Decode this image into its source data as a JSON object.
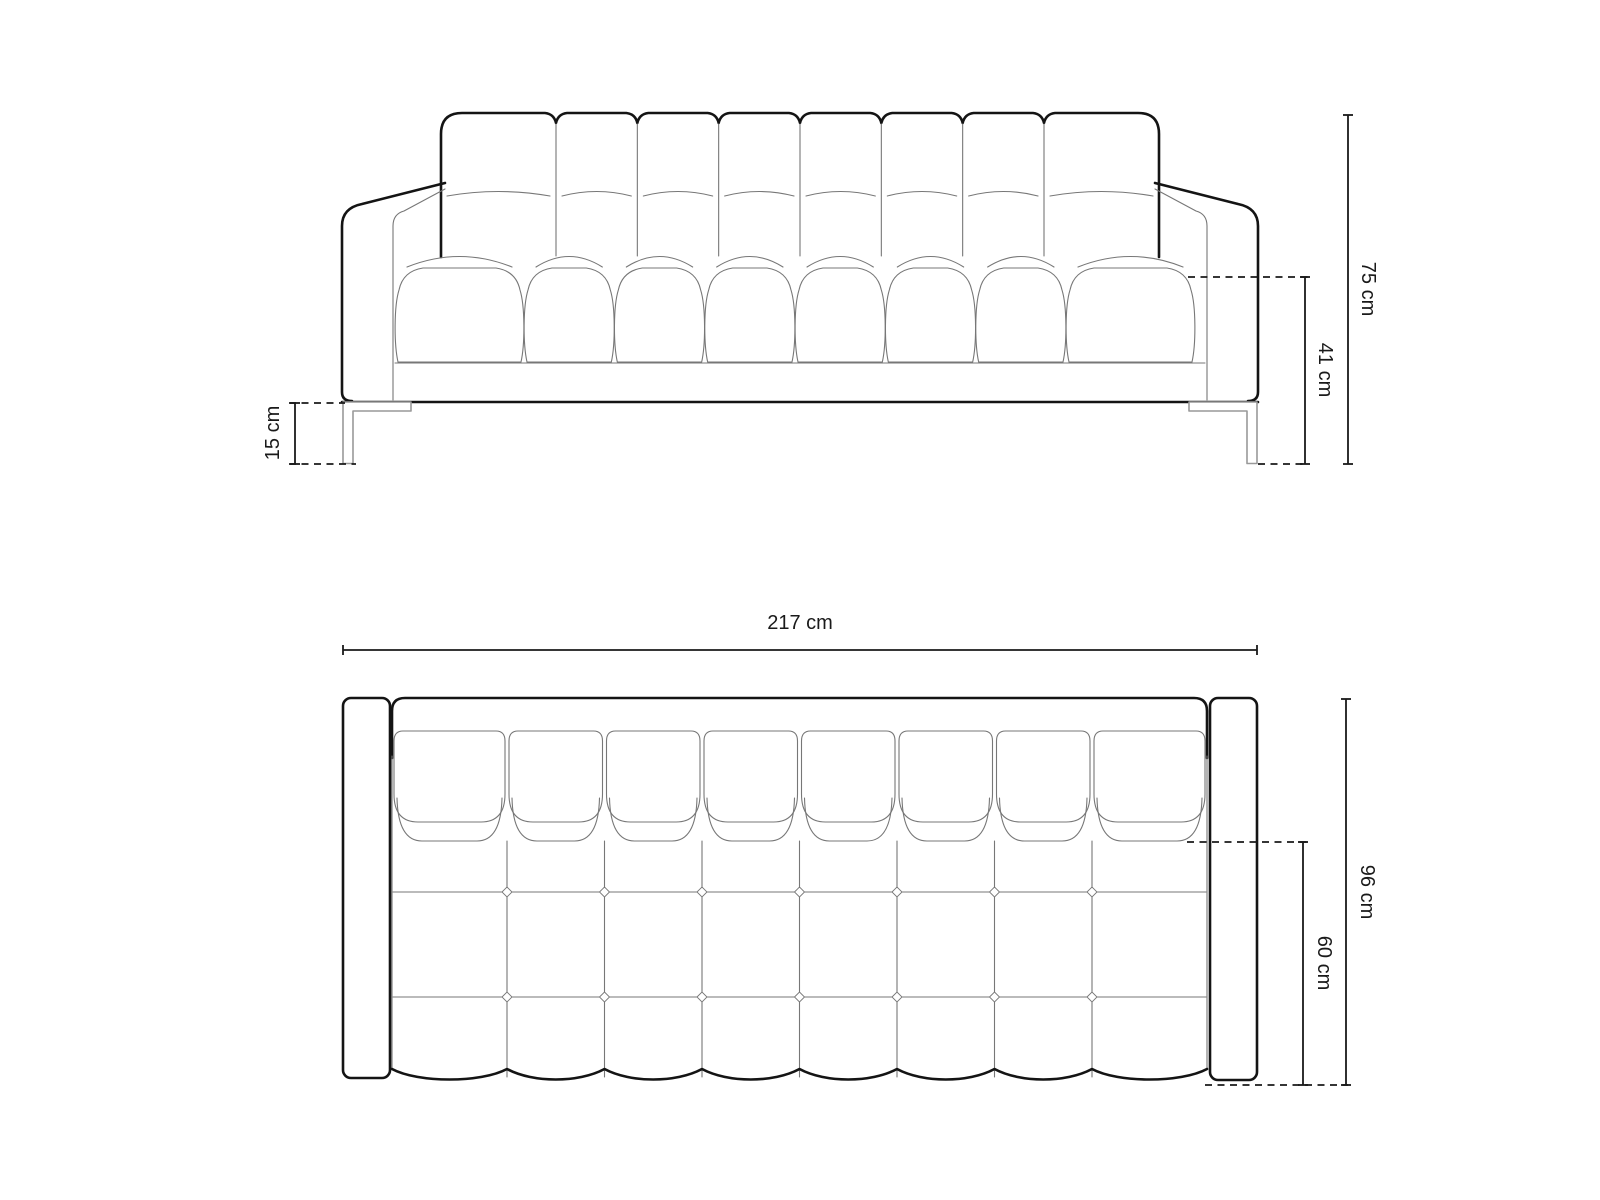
{
  "diagram": {
    "type": "furniture-dimension-drawing",
    "subject": "tufted sofa technical drawing, front elevation and top plan",
    "front_view": {
      "back_cushions": 8,
      "seat_cushions": 8,
      "legs": 2,
      "dims": {
        "height": "75 cm",
        "seat_height": "41 cm",
        "leg_height": "15 cm"
      }
    },
    "top_view": {
      "back_cushions": 8,
      "seat_columns": 8,
      "seat_rows": 3,
      "dims": {
        "width": "217 cm",
        "depth": "96 cm",
        "seat_depth": "60 cm"
      }
    },
    "colors": {
      "outline": "#141414",
      "detail": "#777777",
      "leg": "#999999",
      "dimension": "#1a1a1a",
      "background": "#ffffff"
    }
  }
}
